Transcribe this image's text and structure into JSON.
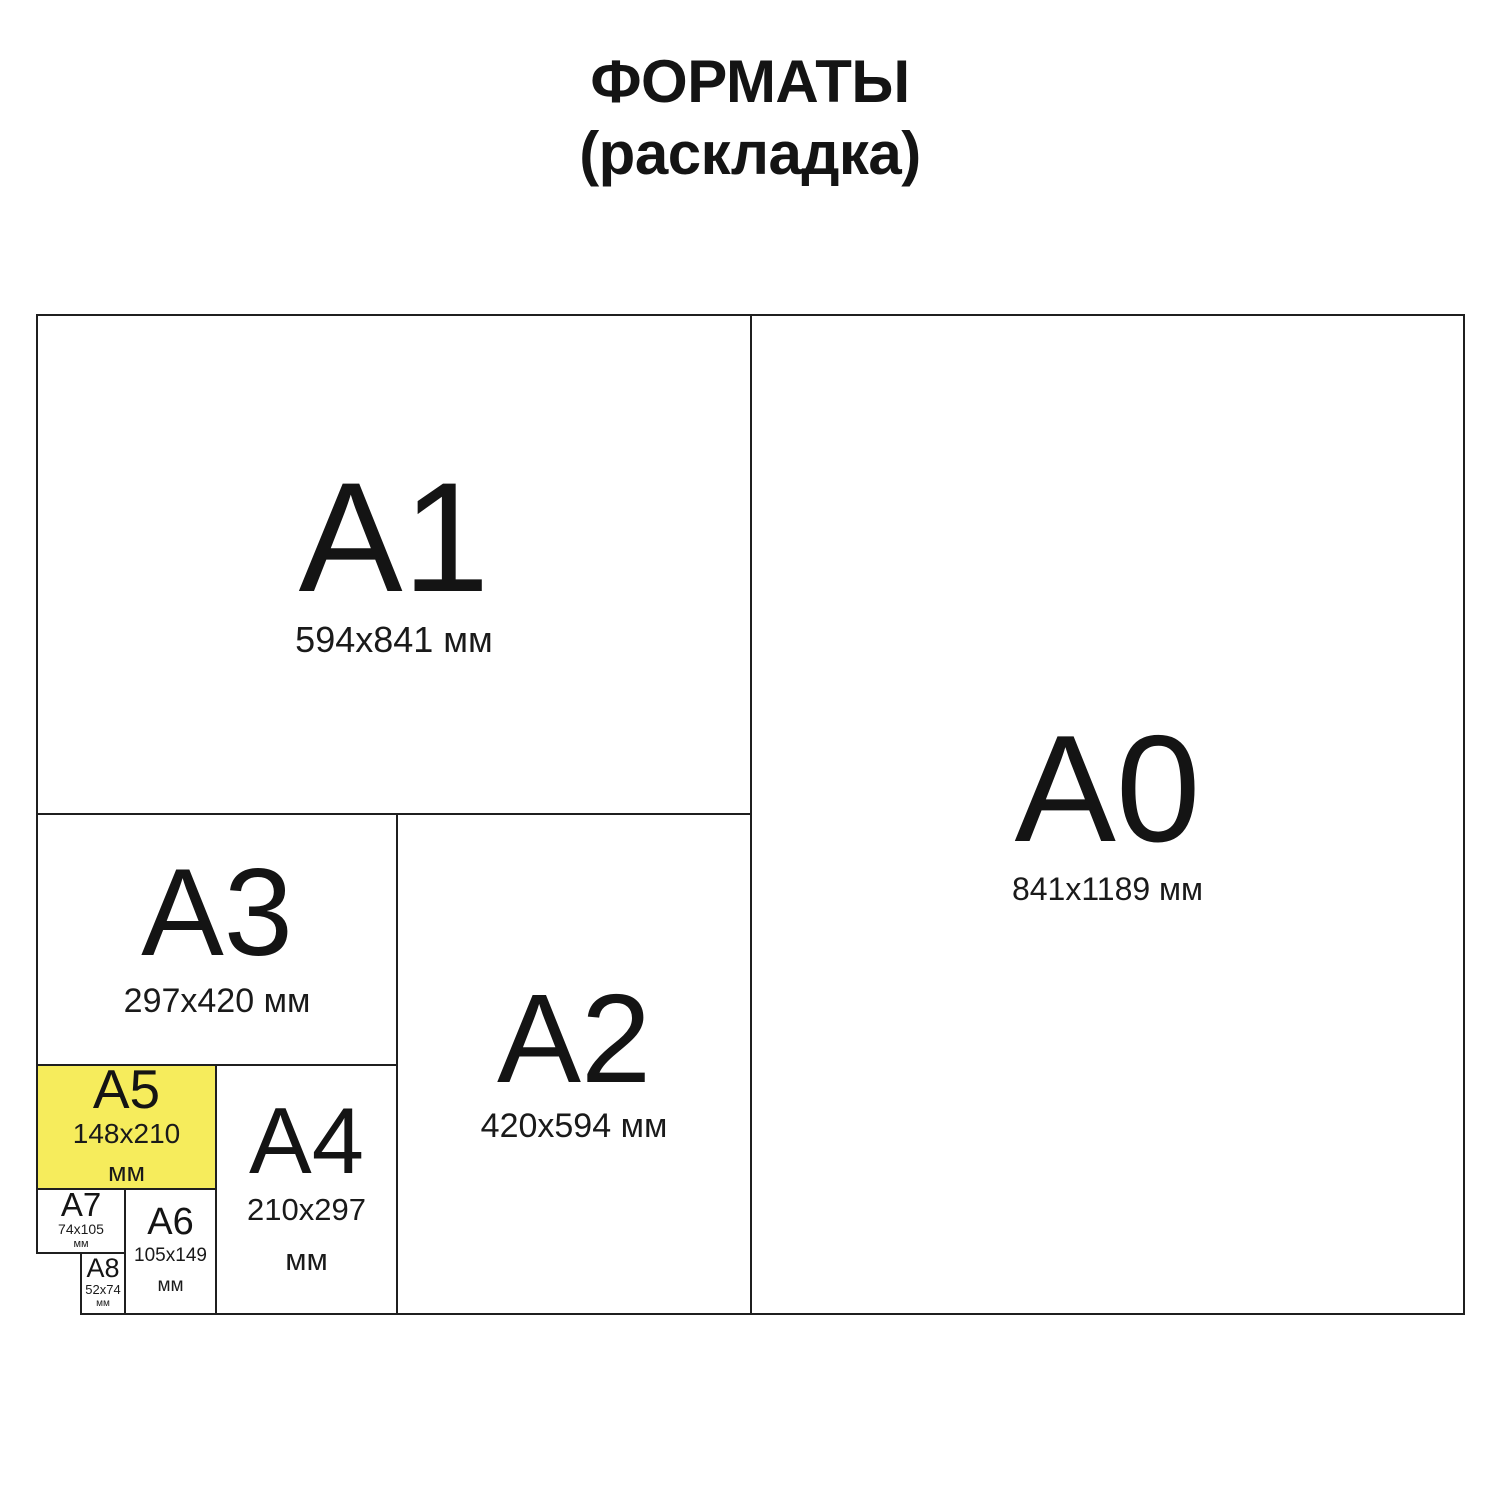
{
  "title": {
    "line1": "ФОРМАТЫ",
    "line2": "(раскладка)"
  },
  "colors": {
    "background": "#ffffff",
    "line": "#1f1f1f",
    "text": "#141414",
    "highlight_fill": "#f6ec5c"
  },
  "formats": {
    "a0": {
      "label": "A0",
      "size": "841x1189 мм"
    },
    "a1": {
      "label": "A1",
      "size": "594x841 мм"
    },
    "a2": {
      "label": "A2",
      "size": "420x594 мм"
    },
    "a3": {
      "label": "A3",
      "size": "297x420 мм"
    },
    "a4": {
      "label": "A4",
      "size": "210x297",
      "unit": "мм"
    },
    "a5": {
      "label": "A5",
      "size": "148x210",
      "unit": "мм",
      "highlighted": true
    },
    "a6": {
      "label": "A6",
      "size": "105x149",
      "unit": "мм"
    },
    "a7": {
      "label": "A7",
      "size": "74x105",
      "unit": "мм"
    },
    "a8": {
      "label": "A8",
      "size": "52x74",
      "unit": "мм"
    }
  }
}
